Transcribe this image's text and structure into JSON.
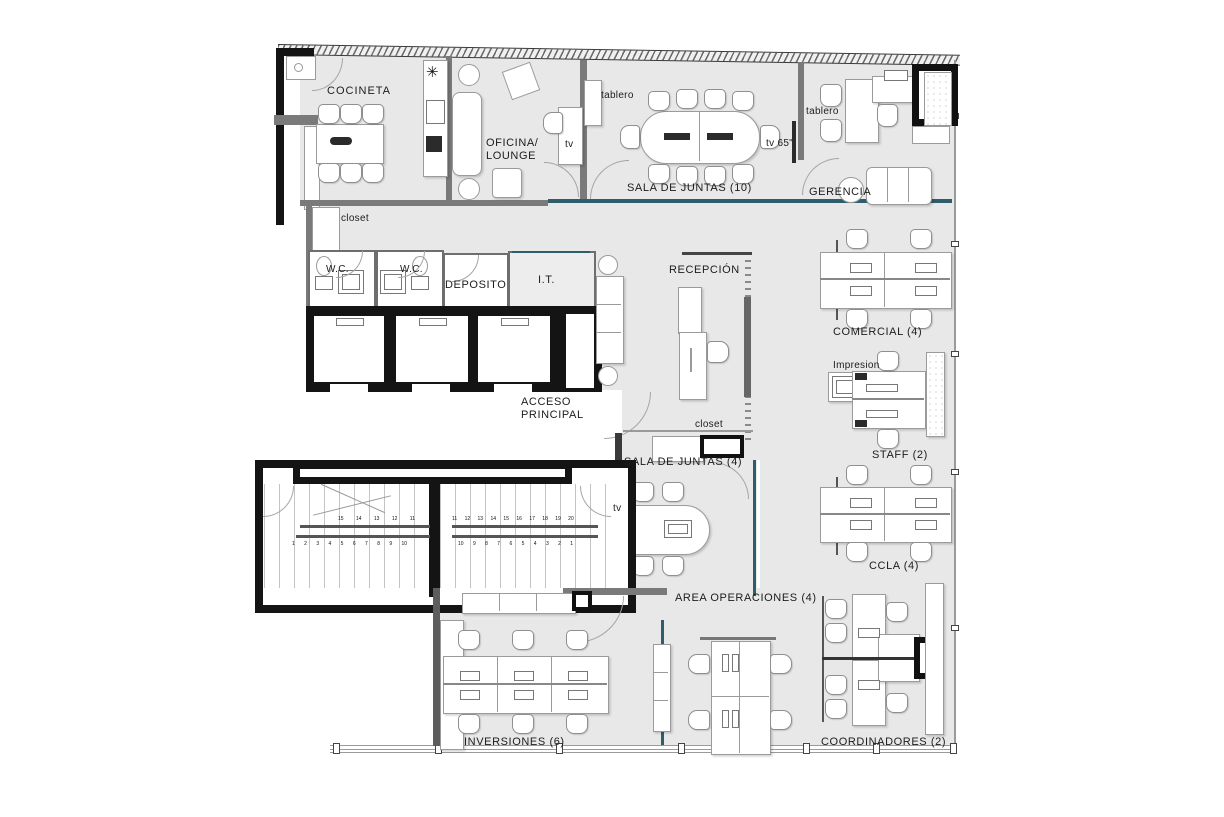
{
  "title": "Office floor plan",
  "colors": {
    "floor": "#e8e8e8",
    "wall_gray": "#7a7a7a",
    "wall_black": "#141414",
    "glass_teal": "#2e5d6d",
    "furniture": "#ffffff",
    "text": "#1c1c1c"
  },
  "icons": {
    "ceiling_fan": "✳"
  },
  "labels": [
    {
      "id": "cocineta",
      "text": "COCINETA"
    },
    {
      "id": "closet-top",
      "text": "closet"
    },
    {
      "id": "oficina-lounge",
      "text": "OFICINA/\nLOUNGE"
    },
    {
      "id": "tv-lounge",
      "text": "tv"
    },
    {
      "id": "tablero-sala10",
      "text": "tablero"
    },
    {
      "id": "sala-juntas-10",
      "text": "SALA DE JUNTAS (10)"
    },
    {
      "id": "tv-65",
      "text": "tv 65\""
    },
    {
      "id": "tablero-gerencia",
      "text": "tablero"
    },
    {
      "id": "gerencia",
      "text": "GERENCIA"
    },
    {
      "id": "wc-1",
      "text": "W.C."
    },
    {
      "id": "wc-2",
      "text": "W.C."
    },
    {
      "id": "deposito",
      "text": "DEPOSITO"
    },
    {
      "id": "it",
      "text": "I.T."
    },
    {
      "id": "recepcion",
      "text": "RECEPCIÓN"
    },
    {
      "id": "comercial",
      "text": "COMERCIAL (4)"
    },
    {
      "id": "impresion",
      "text": "Impresion"
    },
    {
      "id": "staff",
      "text": "STAFF (2)"
    },
    {
      "id": "acceso-principal",
      "text": "ACCESO\nPRINCIPAL"
    },
    {
      "id": "closet-recepcion",
      "text": "closet"
    },
    {
      "id": "sala-juntas-4",
      "text": "SALA DE JUNTAS (4)"
    },
    {
      "id": "tv-sala4",
      "text": "tv"
    },
    {
      "id": "ccla",
      "text": "CCLA (4)"
    },
    {
      "id": "area-operaciones",
      "text": "AREA OPERACIONES (4)"
    },
    {
      "id": "inversiones",
      "text": "INVERSIONES  (6)"
    },
    {
      "id": "coordinadores",
      "text": "COORDINADORES (2)"
    }
  ],
  "stairs": {
    "left_upper": "15 14 13 12 11",
    "left_lower": "1 2 3 4 5 6 7 8 9 10",
    "right_upper": "11 12 13 14 15 16 17 18 19 20",
    "right_lower": "10 9 8 7 6 5 4 3 2 1"
  }
}
